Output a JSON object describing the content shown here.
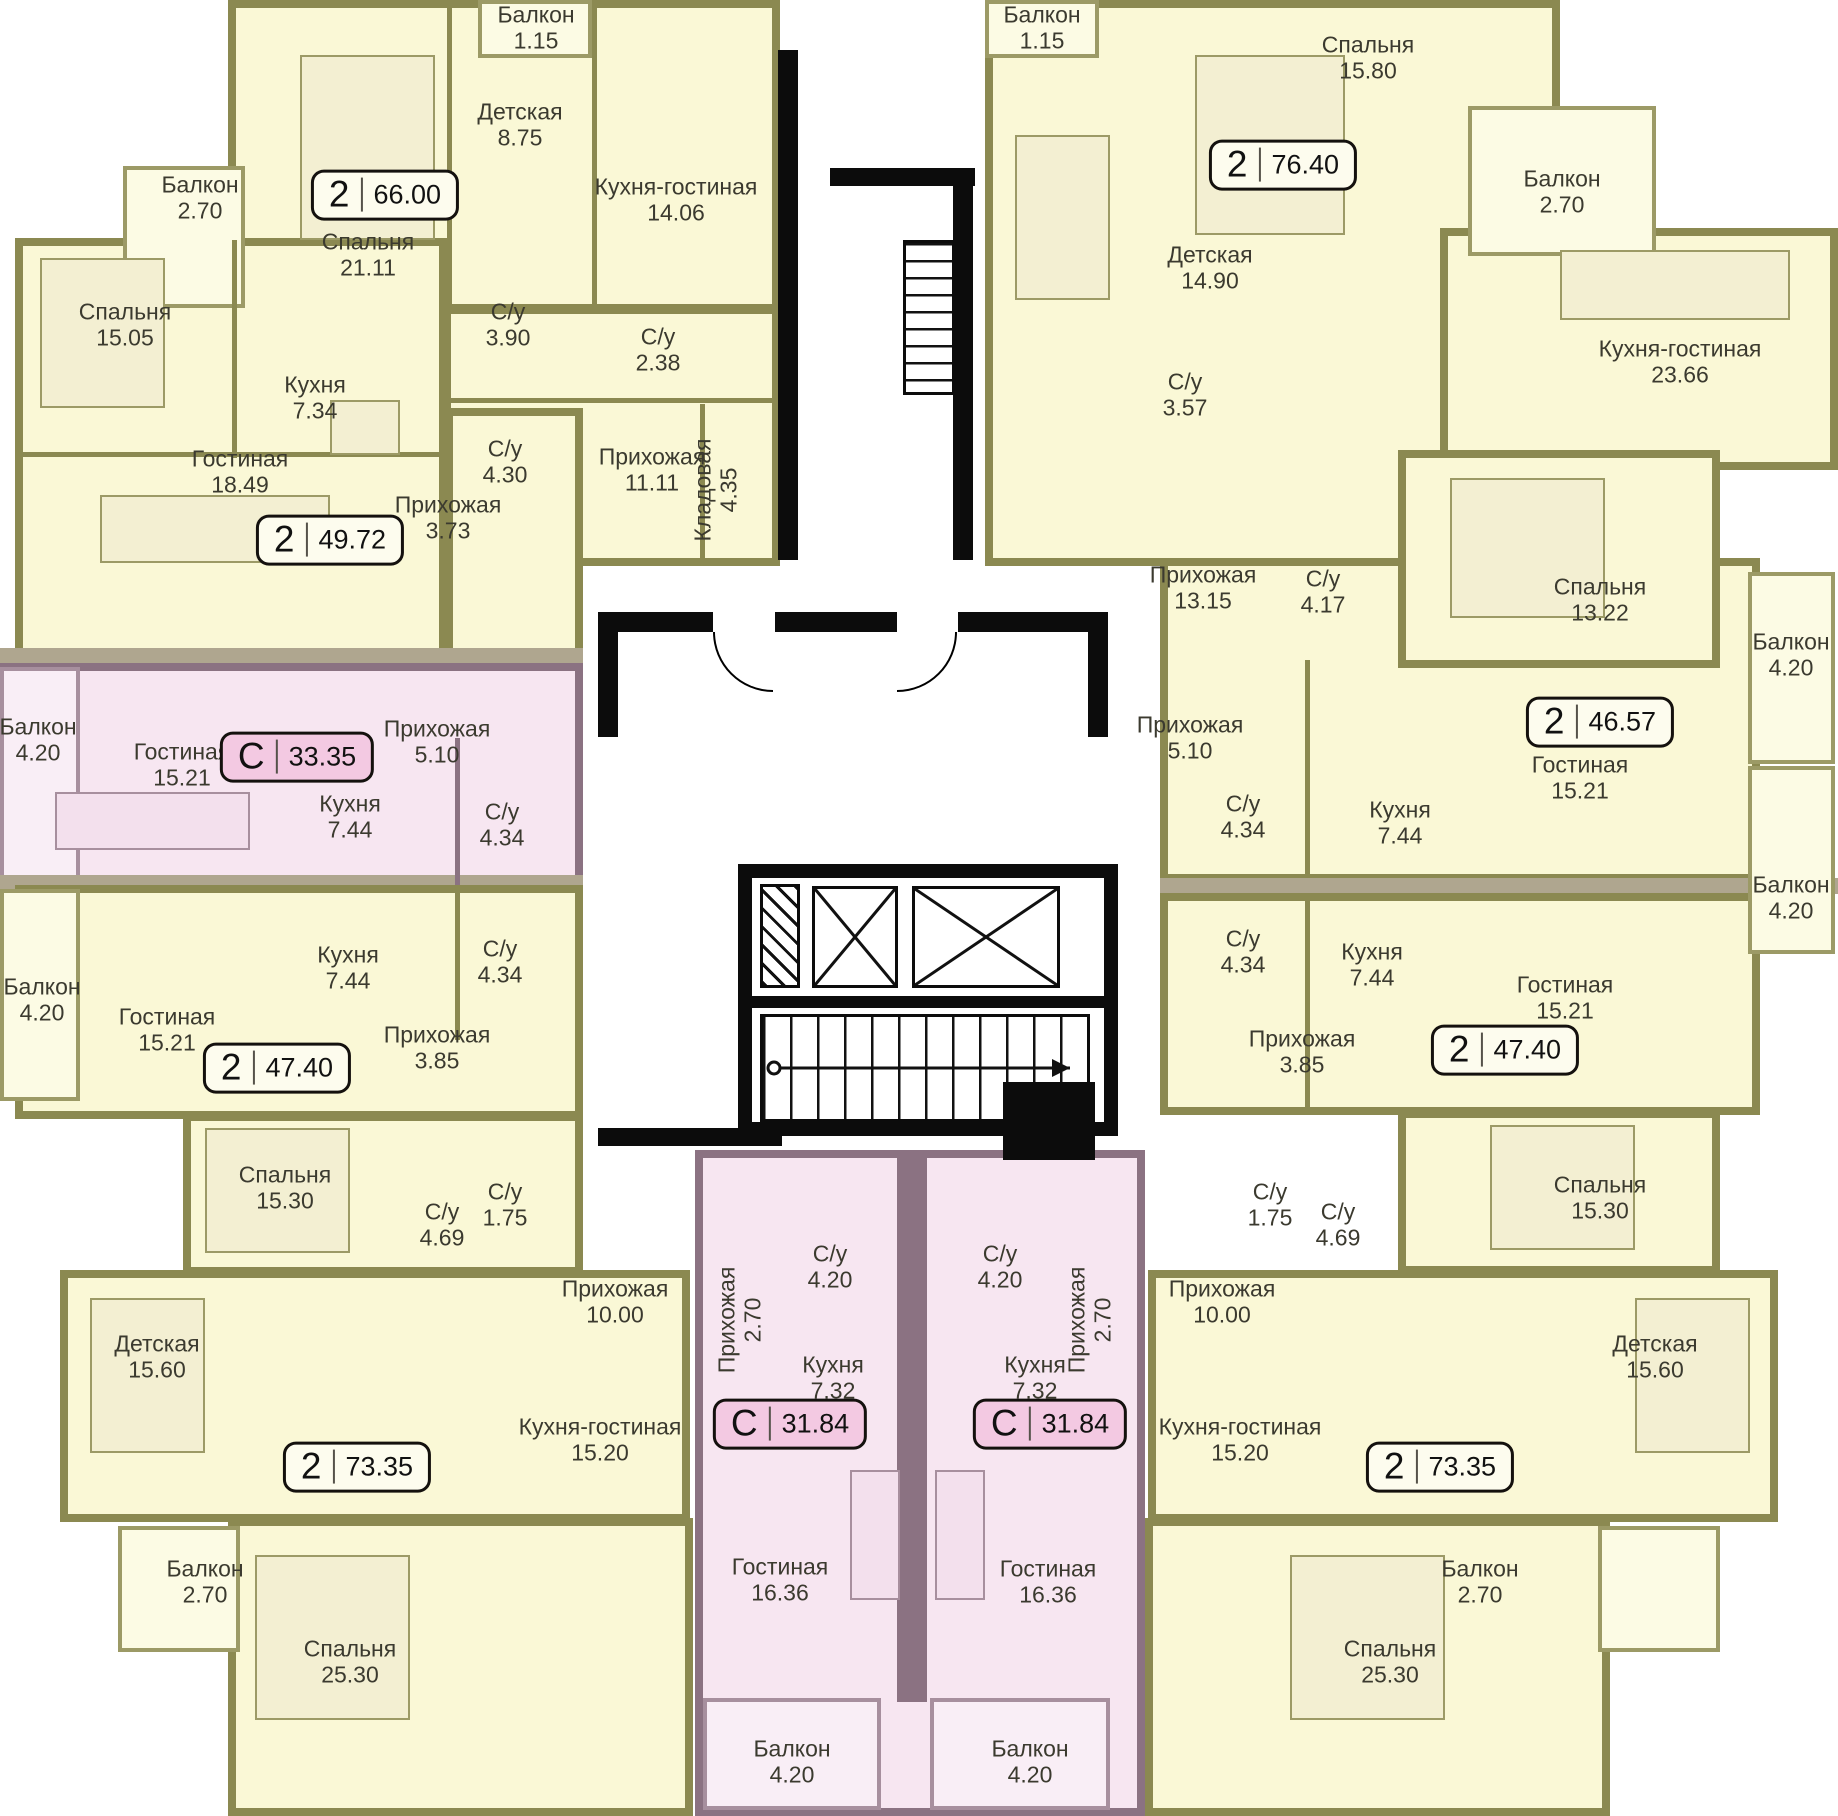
{
  "title": "Поэтажный план жилого дома",
  "colors": {
    "apartment_yellow": "#FAF8D6",
    "apartment_pink": "#F7E6F1",
    "wall_olive": "#8B8951",
    "wall_mauve": "#8B7282",
    "core_black": "#0C0C0C",
    "badge_pink": "#F3C9E2",
    "badge_yellow": "#FDFCEE"
  },
  "apartments": [
    {
      "id": "apt-66-00",
      "type_label": "2",
      "area_label": "66.00",
      "rooms": [
        {
          "name": "Спальня",
          "area": "21.11"
        },
        {
          "name": "Детская",
          "area": "8.75"
        },
        {
          "name": "Балкон",
          "area": "1.15"
        },
        {
          "name": "Кухня-гостиная",
          "area": "14.06"
        },
        {
          "name": "С/у",
          "area": "3.90"
        },
        {
          "name": "С/у",
          "area": "2.38"
        },
        {
          "name": "С/у",
          "area": "4.30"
        },
        {
          "name": "Прихожая",
          "area": "11.11"
        },
        {
          "name": "Кладовая",
          "area": "4.35"
        }
      ]
    },
    {
      "id": "apt-49-72",
      "type_label": "2",
      "area_label": "49.72",
      "rooms": [
        {
          "name": "Балкон",
          "area": "2.70"
        },
        {
          "name": "Спальня",
          "area": "15.05"
        },
        {
          "name": "Кухня",
          "area": "7.34"
        },
        {
          "name": "Гостиная",
          "area": "18.49"
        },
        {
          "name": "Прихожая",
          "area": "3.73"
        }
      ]
    },
    {
      "id": "studio-33-35",
      "type_label": "С",
      "area_label": "33.35",
      "rooms": [
        {
          "name": "Балкон",
          "area": "4.20"
        },
        {
          "name": "Гостиная",
          "area": "15.21"
        },
        {
          "name": "Прихожая",
          "area": "5.10"
        },
        {
          "name": "Кухня",
          "area": "7.44"
        },
        {
          "name": "С/у",
          "area": "4.34"
        }
      ]
    },
    {
      "id": "apt-47-40-left",
      "type_label": "2",
      "area_label": "47.40",
      "rooms": [
        {
          "name": "Балкон",
          "area": "4.20"
        },
        {
          "name": "Гостиная",
          "area": "15.21"
        },
        {
          "name": "Кухня",
          "area": "7.44"
        },
        {
          "name": "С/у",
          "area": "4.34"
        },
        {
          "name": "Прихожая",
          "area": "3.85"
        },
        {
          "name": "Спальня",
          "area": "15.30"
        }
      ]
    },
    {
      "id": "apt-73-35-left",
      "type_label": "2",
      "area_label": "73.35",
      "rooms": [
        {
          "name": "С/у",
          "area": "4.69"
        },
        {
          "name": "С/у",
          "area": "1.75"
        },
        {
          "name": "Детская",
          "area": "15.60"
        },
        {
          "name": "Прихожая",
          "area": "10.00"
        },
        {
          "name": "Кухня-гостиная",
          "area": "15.20"
        },
        {
          "name": "Балкон",
          "area": "2.70"
        },
        {
          "name": "Спальня",
          "area": "25.30"
        }
      ]
    },
    {
      "id": "studio-31-84-left",
      "type_label": "С",
      "area_label": "31.84",
      "rooms": [
        {
          "name": "С/у",
          "area": "4.20"
        },
        {
          "name": "Прихожая",
          "area": "2.70"
        },
        {
          "name": "Кухня",
          "area": "7.32"
        },
        {
          "name": "Гостиная",
          "area": "16.36"
        },
        {
          "name": "Балкон",
          "area": "4.20"
        }
      ]
    },
    {
      "id": "studio-31-84-right",
      "type_label": "С",
      "area_label": "31.84",
      "rooms": [
        {
          "name": "С/у",
          "area": "4.20"
        },
        {
          "name": "Прихожая",
          "area": "2.70"
        },
        {
          "name": "Кухня",
          "area": "7.32"
        },
        {
          "name": "Гостиная",
          "area": "16.36"
        },
        {
          "name": "Балкон",
          "area": "4.20"
        }
      ]
    },
    {
      "id": "apt-76-40",
      "type_label": "2",
      "area_label": "76.40",
      "rooms": [
        {
          "name": "Балкон",
          "area": "1.15"
        },
        {
          "name": "Спальня",
          "area": "15.80"
        },
        {
          "name": "Детская",
          "area": "14.90"
        },
        {
          "name": "С/у",
          "area": "3.57"
        },
        {
          "name": "Балкон",
          "area": "2.70"
        },
        {
          "name": "Кухня-гостиная",
          "area": "23.66"
        },
        {
          "name": "Прихожая",
          "area": "13.15"
        },
        {
          "name": "С/у",
          "area": "4.17"
        }
      ]
    },
    {
      "id": "apt-46-57",
      "type_label": "2",
      "area_label": "46.57",
      "rooms": [
        {
          "name": "Спальня",
          "area": "13.22"
        },
        {
          "name": "Гостиная",
          "area": "15.21"
        },
        {
          "name": "Балкон",
          "area": "4.20"
        },
        {
          "name": "Прихожая",
          "area": "5.10"
        },
        {
          "name": "С/у",
          "area": "4.34"
        },
        {
          "name": "Кухня",
          "area": "7.44"
        }
      ]
    },
    {
      "id": "apt-47-40-right",
      "type_label": "2",
      "area_label": "47.40",
      "rooms": [
        {
          "name": "С/у",
          "area": "4.34"
        },
        {
          "name": "Кухня",
          "area": "7.44"
        },
        {
          "name": "Гостиная",
          "area": "15.21"
        },
        {
          "name": "Прихожая",
          "area": "3.85"
        },
        {
          "name": "Балкон",
          "area": "4.20"
        },
        {
          "name": "Спальня",
          "area": "15.30"
        }
      ]
    },
    {
      "id": "apt-73-35-right",
      "type_label": "2",
      "area_label": "73.35",
      "rooms": [
        {
          "name": "С/у",
          "area": "1.75"
        },
        {
          "name": "С/у",
          "area": "4.69"
        },
        {
          "name": "Прихожая",
          "area": "10.00"
        },
        {
          "name": "Детская",
          "area": "15.60"
        },
        {
          "name": "Кухня-гостиная",
          "area": "15.20"
        },
        {
          "name": "Балкон",
          "area": "2.70"
        },
        {
          "name": "Спальня",
          "area": "25.30"
        }
      ]
    }
  ]
}
